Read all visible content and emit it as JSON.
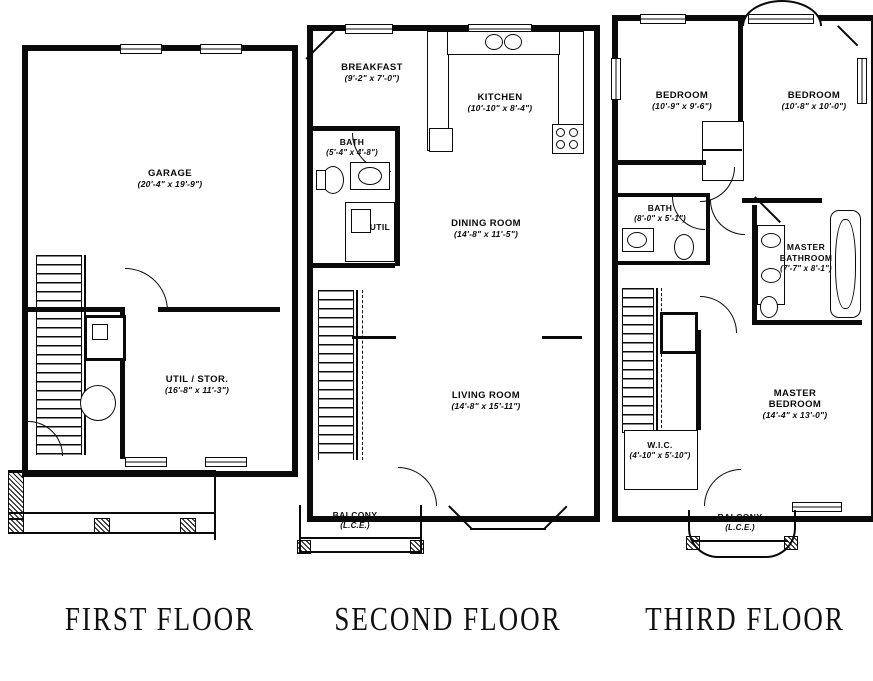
{
  "colors": {
    "ink": "#0a0a0a",
    "paper": "#ffffff"
  },
  "titles": {
    "first": "FIRST FLOOR",
    "second": "SECOND FLOOR",
    "third": "THIRD FLOOR"
  },
  "first": {
    "garage_name": "GARAGE",
    "garage_dims": "(20'-4\" x 19'-9\")",
    "util_name": "UTIL / STOR.",
    "util_dims": "(16'-8\" x 11'-3\")"
  },
  "second": {
    "breakfast_name": "BREAKFAST",
    "breakfast_dims": "(9'-2\" x 7'-0\")",
    "kitchen_name": "KITCHEN",
    "kitchen_dims": "(10'-10\" x 8'-4\")",
    "bath_name": "BATH",
    "bath_dims": "(5'-4\" x 4'-8\")",
    "util_label": "UTIL",
    "dining_name": "DINING ROOM",
    "dining_dims": "(14'-8\" x 11'-5\")",
    "living_name": "LIVING ROOM",
    "living_dims": "(14'-8\" x 15'-11\")",
    "balcony_name": "BALCONY",
    "balcony_dims": "(L.C.E.)"
  },
  "third": {
    "bedroom1_name": "BEDROOM",
    "bedroom1_dims": "(10'-9\" x 9'-6\")",
    "bedroom2_name": "BEDROOM",
    "bedroom2_dims": "(10'-8\" x 10'-0\")",
    "bath_name": "BATH",
    "bath_dims": "(8'-0\" x 5'-1\")",
    "mbath_line1": "MASTER",
    "mbath_line2": "BATHROOM",
    "mbath_dims": "(7'-7\" x 8'-1\")",
    "mbed_line1": "MASTER",
    "mbed_line2": "BEDROOM",
    "mbed_dims": "(14'-4\" x 13'-0\")",
    "wic_name": "W.I.C.",
    "wic_dims": "(4'-10\" x 5'-10\")",
    "balcony_name": "BALCONY",
    "balcony_dims": "(L.C.E.)"
  }
}
